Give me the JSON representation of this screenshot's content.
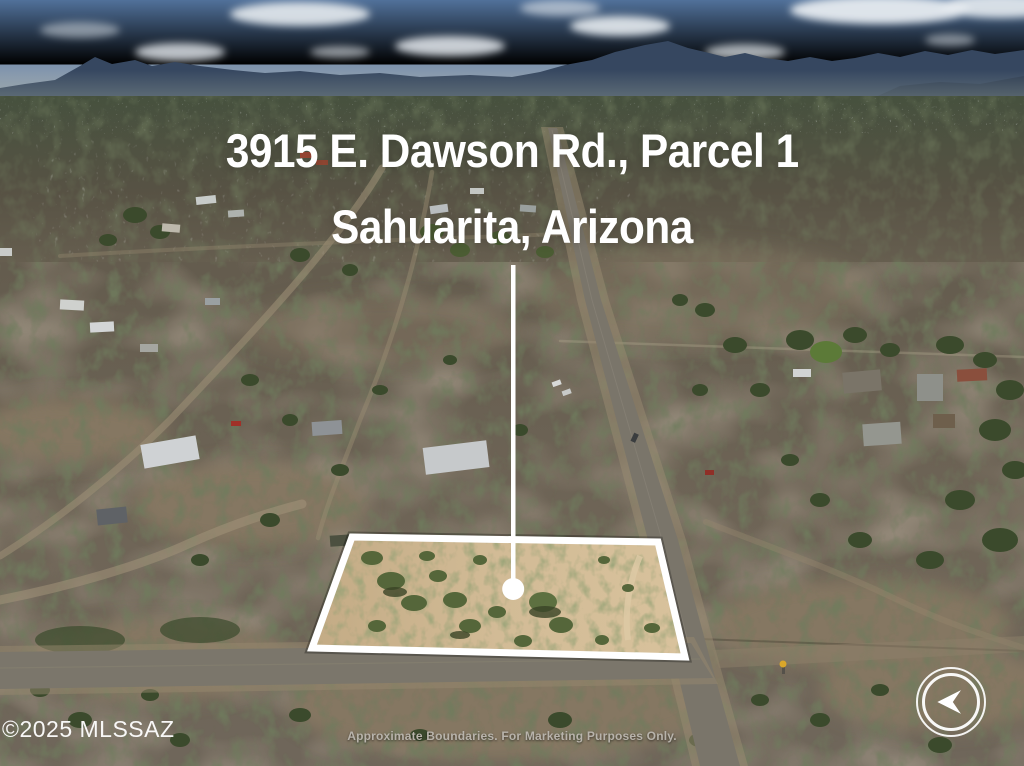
{
  "photo": {
    "title": {
      "line1": "3915 E. Dawson Rd., Parcel 1",
      "line2": "Sahuarita, Arizona"
    },
    "watermark": "©2025 MLSSAZ",
    "disclaimer": "Approximate Boundaries. For Marketing Purposes Only.",
    "parcel": {
      "outline_points": "352,537 658,542 685,657 312,648",
      "marker": "white-circle-pin"
    },
    "navigation": {
      "direction": "previous",
      "icon": "arrow-left"
    }
  },
  "colors": {
    "boundary": "#ffffff",
    "title_text": "#ffffff",
    "watermark_text": "#ffffff",
    "disclaimer_text": "#b8b3ab"
  }
}
